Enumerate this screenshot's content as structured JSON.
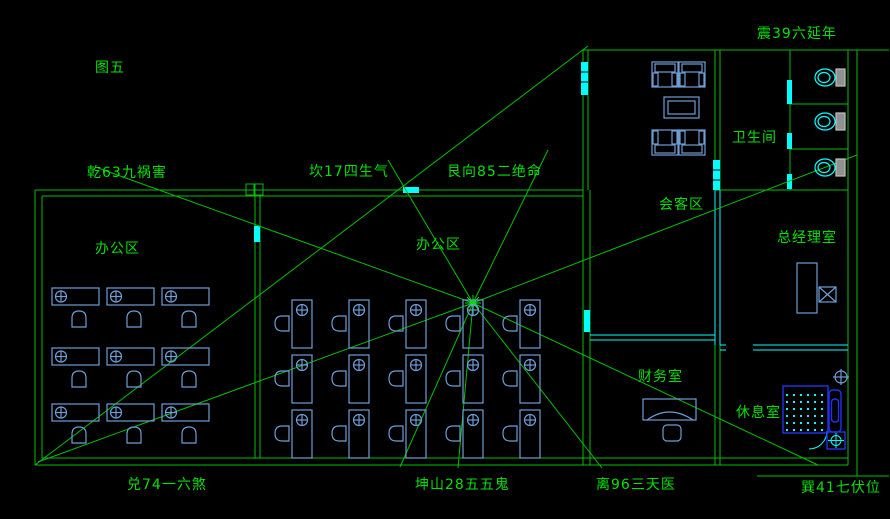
{
  "canvas": {
    "width": 890,
    "height": 519,
    "background": "#000000"
  },
  "colors": {
    "wall_green": "#00c000",
    "label_green": "#00e000",
    "partition_cyan": "#00ffff",
    "furniture_blue": "#6d9ed6",
    "fixture_blue": "#2233ee",
    "tank_gray": "#909090"
  },
  "labels": {
    "tuwu": "图五",
    "zhen": "震39六延年",
    "qian": "乾63九祸害",
    "kan": "坎17四生气",
    "gen": "艮向85二绝命",
    "dui": "兑74一六煞",
    "kunshan": "坤山28五五鬼",
    "li": "离96三天医",
    "xun": "巽41七伏位",
    "meeting": "会客区",
    "bathroom": "卫生间",
    "gm": "总经理室",
    "office_left": "办公区",
    "office_mid": "办公区",
    "finance": "财务室",
    "rest": "休息室"
  },
  "plan": {
    "center_point": {
      "x": 473,
      "y": 303
    },
    "rooms": [
      "会客区",
      "卫生间",
      "总经理室",
      "办公区",
      "办公区",
      "财务室",
      "休息室"
    ],
    "furniture": {
      "left_office_desks": 9,
      "middle_office_desks": 15,
      "toilets": 3,
      "sofas": 4,
      "coffee_tables": 1,
      "manager_desks": 1,
      "finance_desks": 1,
      "shower_units": 1
    }
  }
}
